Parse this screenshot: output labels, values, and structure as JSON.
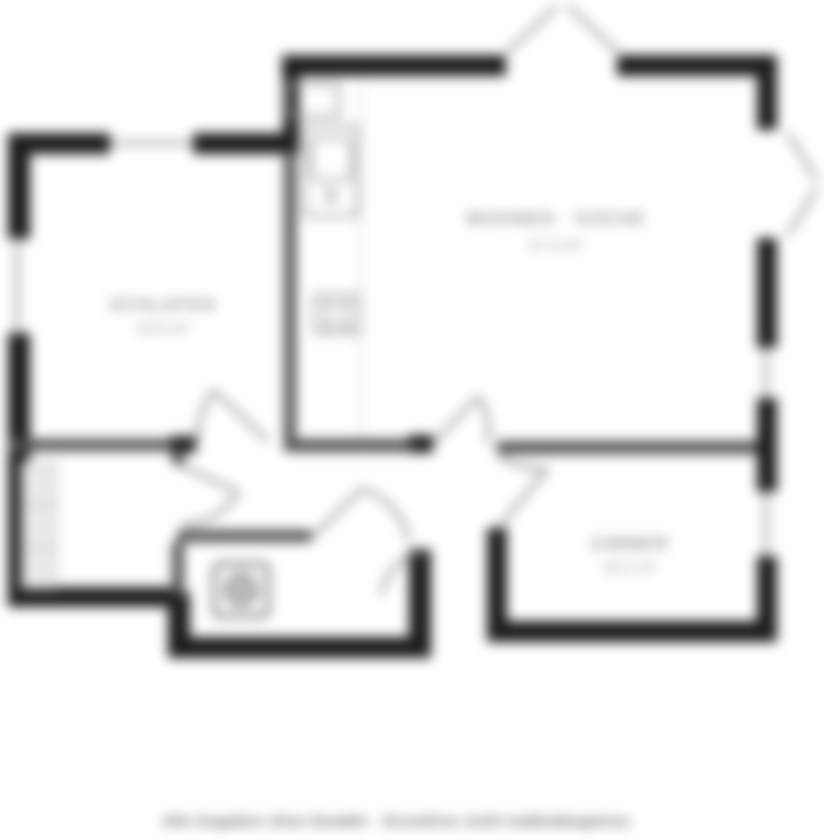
{
  "colors": {
    "wall": "#1c1c1c",
    "partition": "#4f4f4f",
    "window": "#9a9a9a",
    "door": "#777777",
    "fixture": "#999999",
    "appliance": "#565656",
    "wardrobe_fill": "#e9e9e9",
    "label": "#5a5a5a",
    "label_area": "#7a7a7a",
    "watermark": "#5f5f5f",
    "background": "#ffffff"
  },
  "rooms": [
    {
      "id": "bedroom",
      "name": "SCHLAFEN",
      "area": "13,9 m²"
    },
    {
      "id": "living-kitchen",
      "name": "WOHNEN · KÜCHE",
      "area": "27,5 m²"
    },
    {
      "id": "room-2",
      "name": "ZIMMER",
      "area": "10,2 m²"
    }
  ],
  "watermark": {
    "text": "Alle Angaben ohne Gewähr · Grundriss nicht maßstabsgetreu"
  }
}
